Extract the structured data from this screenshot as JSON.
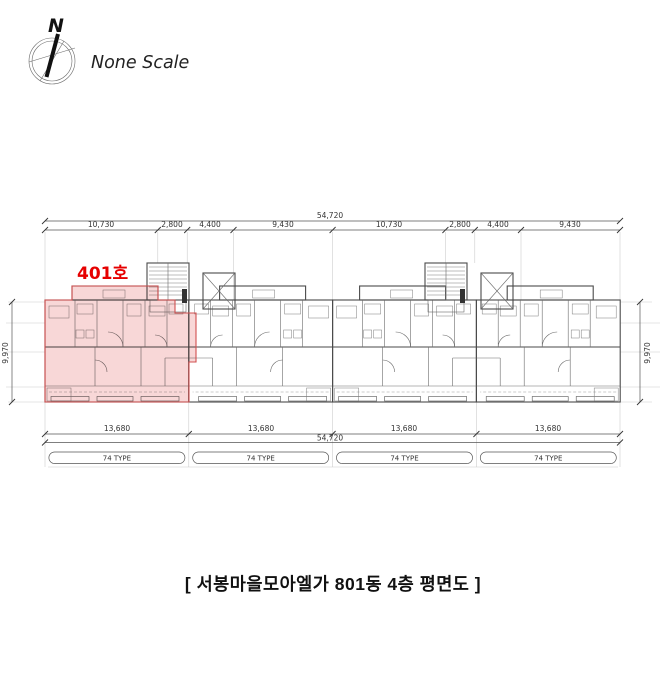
{
  "compass": {
    "north": "N",
    "scale": "None Scale"
  },
  "unit_callout": {
    "label": "401호",
    "color": "#e60000"
  },
  "highlight": {
    "fill": "#f3b6b6",
    "stroke": "#d05050"
  },
  "dimensions": {
    "top_total": "54,720",
    "top_segments": [
      "10,730",
      "2,800",
      "4,400",
      "9,430",
      "10,730",
      "2,800",
      "4,400",
      "9,430"
    ],
    "left_height": "9,970",
    "right_height": "9,970",
    "bottom_segments": [
      "13,680",
      "13,680",
      "13,680",
      "13,680"
    ],
    "bottom_total": "54,720"
  },
  "type_labels": [
    "74 TYPE",
    "74 TYPE",
    "74 TYPE",
    "74 TYPE"
  ],
  "caption": "[ 서봉마을모아엘가 801동 4층 평면도 ]"
}
